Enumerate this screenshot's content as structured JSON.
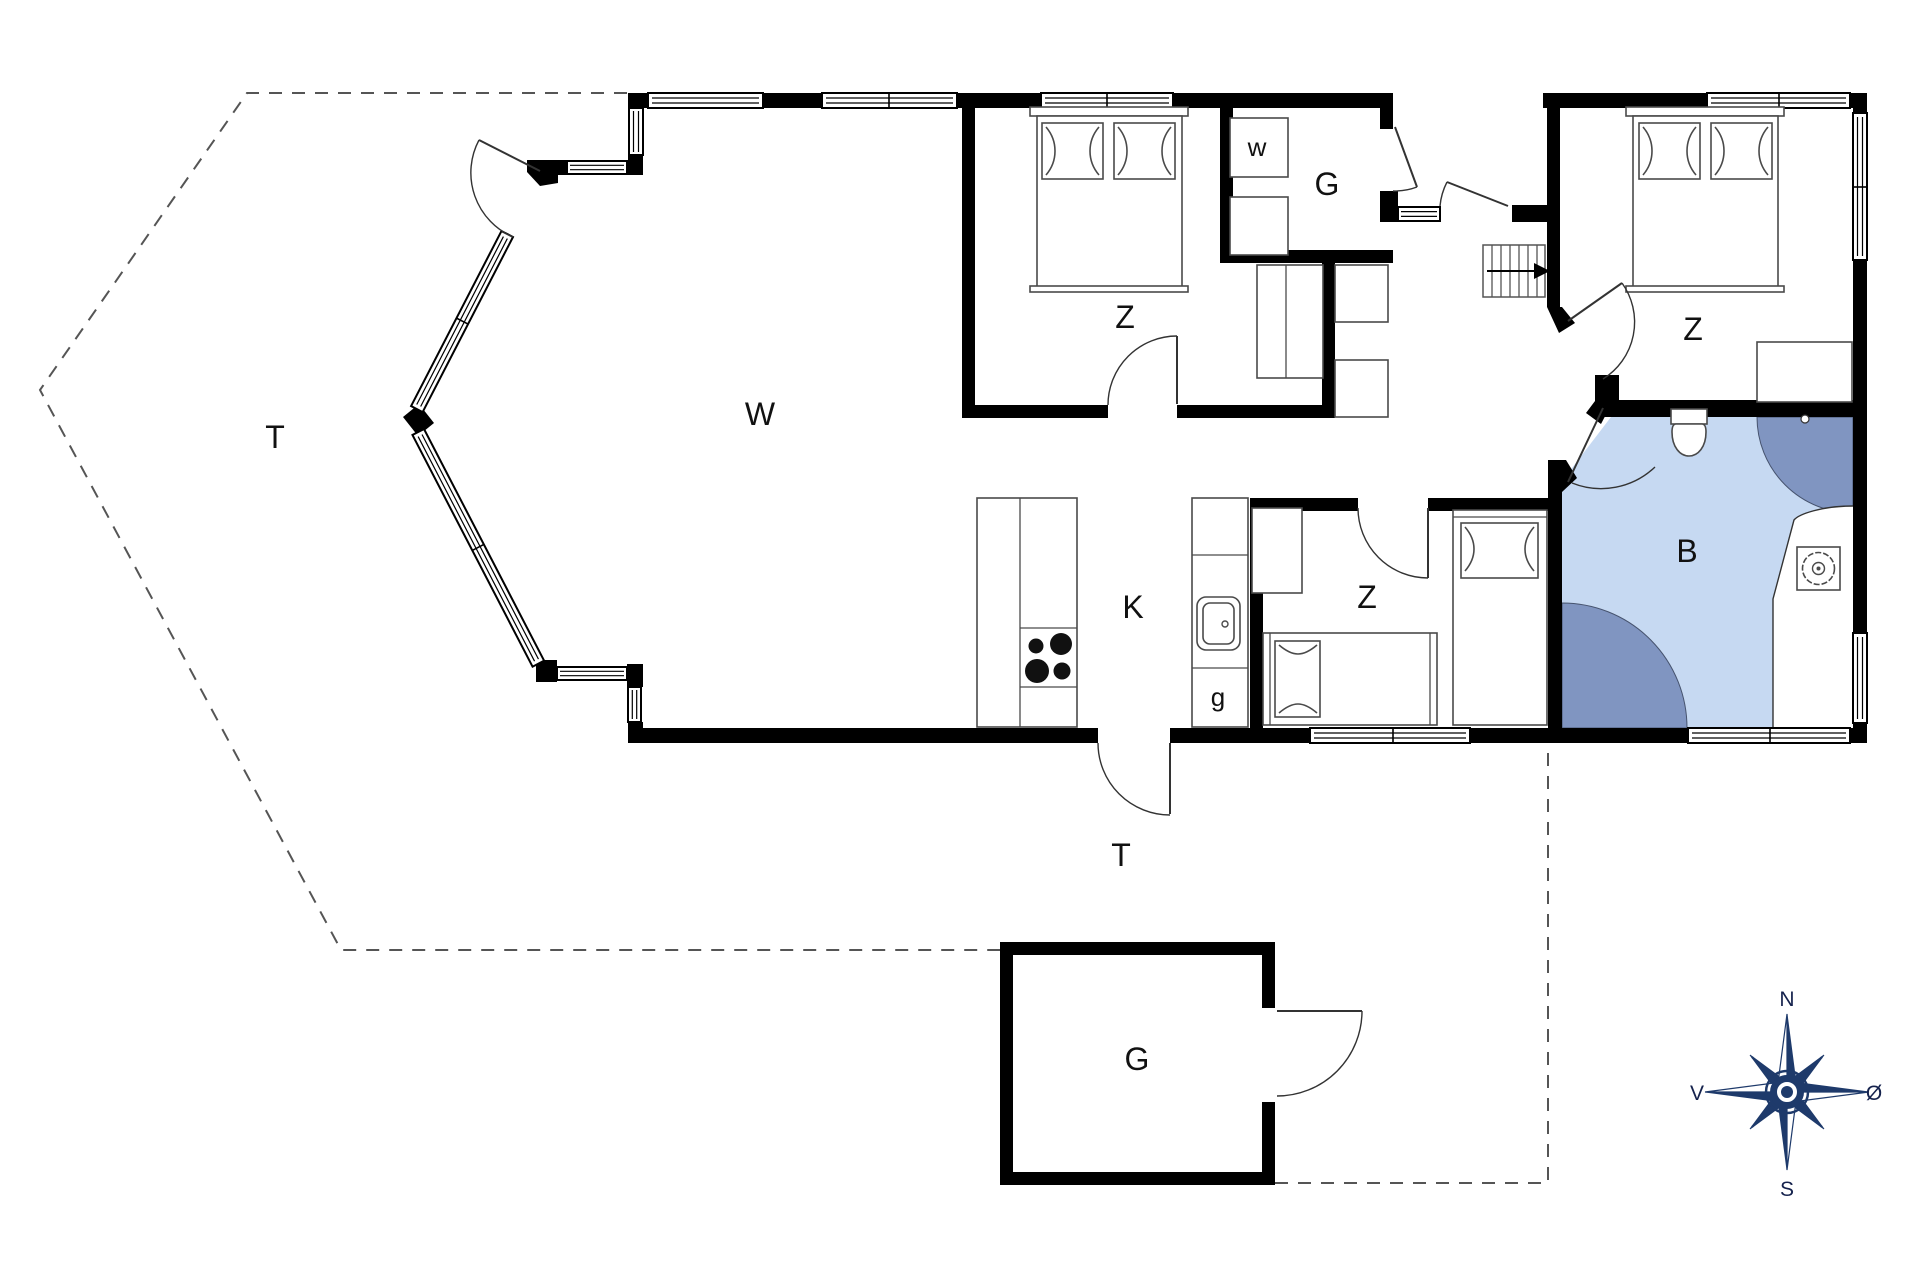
{
  "plan": {
    "type": "floor-plan",
    "labels": {
      "living": "W",
      "terrace_west": "T",
      "terrace_south": "T",
      "bedroom_top": "Z",
      "bedroom_right": "Z",
      "bedroom_middle": "Z",
      "kitchen": "K",
      "bathroom": "B",
      "utility_w": "w",
      "entry_room": "G",
      "pantry_g": "g",
      "outbuilding": "G"
    },
    "compass": {
      "north": "N",
      "south": "S",
      "west": "V",
      "east": "Ø"
    },
    "colors": {
      "wall": "#000000",
      "bathroom_floor": "#c6d9f2",
      "shower": "#8095c1",
      "compass": "#1e3a6b",
      "boundary_dash": "#555555"
    },
    "icons": {
      "compass_rose": "8-point star with N/S/V/Ø",
      "stove": "4 burner circles",
      "sink": "rounded basin with tap dot",
      "toilet": "tank + bowl",
      "washbasin": "square with scalloped circle",
      "stairs": "treads with direction arrow",
      "beds": "rect with pillows",
      "windows": "triple-line glazing",
      "doors": "leaf with quarter-circle swing"
    }
  }
}
